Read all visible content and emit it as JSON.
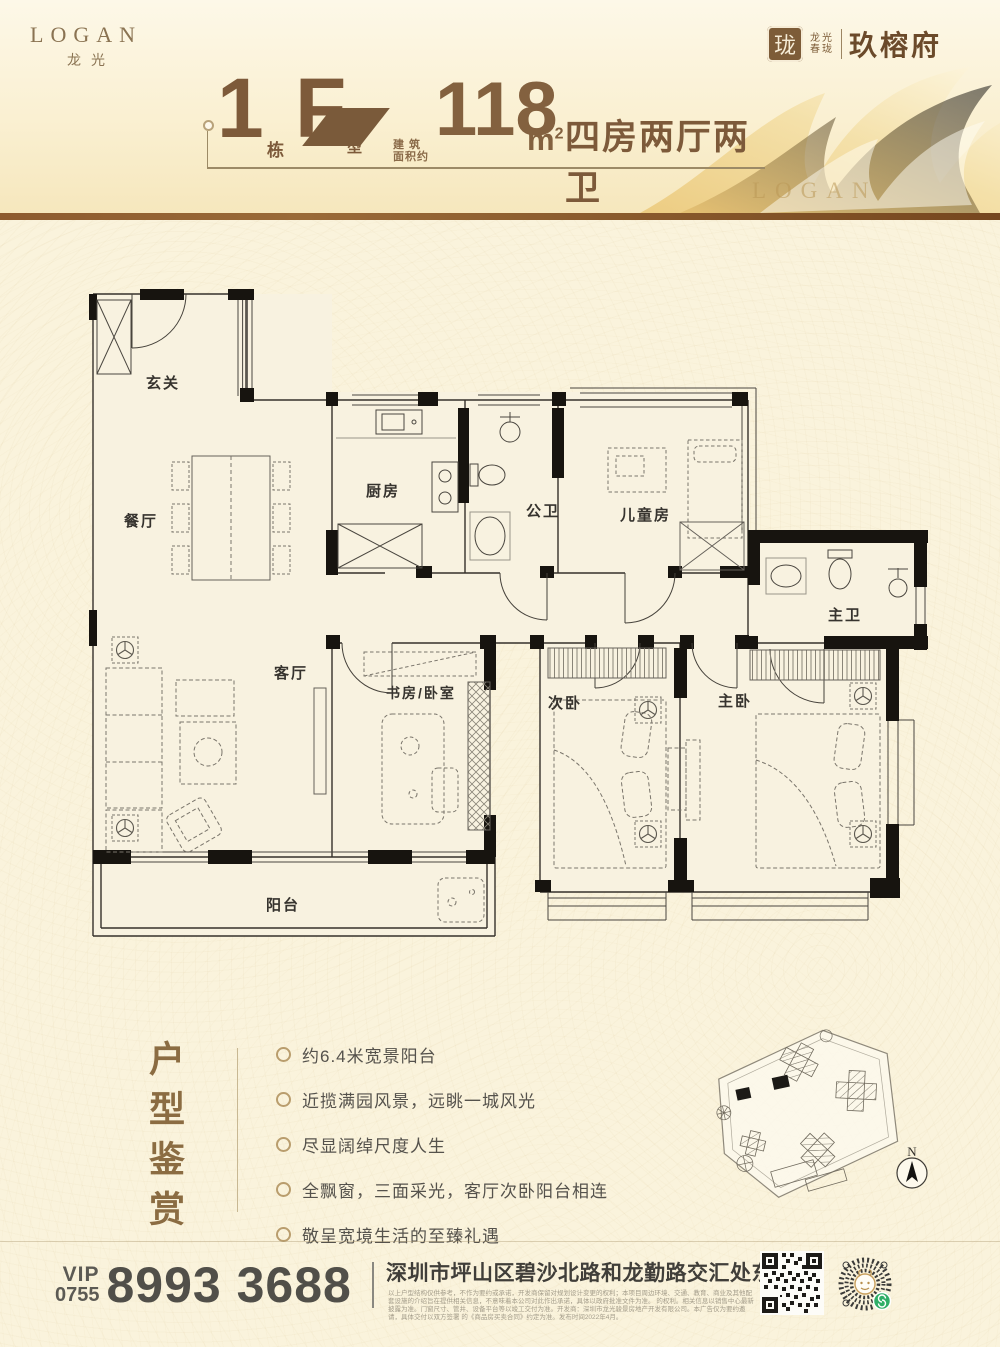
{
  "header": {
    "logo_en": "LOGAN",
    "logo_cn": "龙光",
    "brand": {
      "seal_char": "珑",
      "mini_line1": "龙光",
      "mini_line2": "春珑",
      "project": "玖榕府"
    },
    "watermark": "LOGAN",
    "title": {
      "block_number": "1",
      "block_suffix": "栋",
      "unit_letter": "F",
      "unit_label_1": "户",
      "unit_label_2": "型",
      "area_label_1": "建 筑",
      "area_label_2": "面积约",
      "area_number": "118",
      "area_unit": "m",
      "area_power": "2",
      "spec": "四房两厅两卫"
    }
  },
  "floorplan": {
    "rooms": [
      {
        "label": "玄关"
      },
      {
        "label": "餐厅"
      },
      {
        "label": "厨房"
      },
      {
        "label": "公卫"
      },
      {
        "label": "儿童房"
      },
      {
        "label": "主卫"
      },
      {
        "label": "客厅"
      },
      {
        "label": "书房/卧室"
      },
      {
        "label": "次卧"
      },
      {
        "label": "主卧"
      },
      {
        "label": "阳台"
      }
    ]
  },
  "features": {
    "section_title": "户型鉴赏",
    "items": [
      "约6.4米宽景阳台",
      "近揽满园风景，远眺一城风光",
      "尽显阔绰尺度人生",
      "全飘窗，三面采光，客厅次卧阳台相连",
      "敬呈宽境生活的至臻礼遇"
    ]
  },
  "siteplan": {
    "compass": "N"
  },
  "footer": {
    "vip": "VIP",
    "area_code": "0755",
    "phone": "8993 3688",
    "address": "深圳市坪山区碧沙北路和龙勤路交汇处东南角",
    "disclaimer_lines": [
      "以上户型结构仅供参考，不作为要约或承诺，开发商保留对规划设计变更的权利；本项目周边环境、交通、教育、商业及其他配套设施的介绍旨在提供相关信息，不意味着本公司对此作出承诺，具体以政府批准文件为准。",
      "的权利。相关信息以销售中心最新披露为准。门窗尺寸、管井、设备平台等以竣工交付为准。开发商：深圳市龙光骏景房地产开发有限公司。本广告仅为要约邀请，具体交付以双方签署",
      "的《商品房买卖合同》约定为准。发布时间2022年4月。"
    ]
  },
  "colors": {
    "accent": "#7d5a3a",
    "rule": "#8d5a2e",
    "wall": "#17140f",
    "green_badge": "#2fae67"
  }
}
